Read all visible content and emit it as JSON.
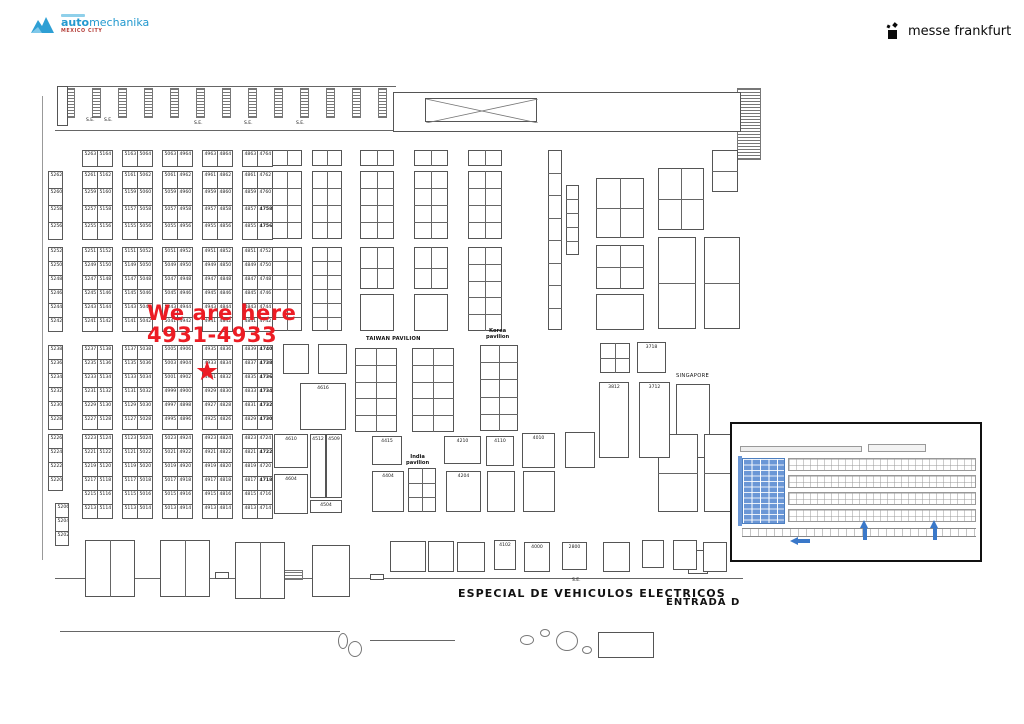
{
  "brand": {
    "part1": "auto",
    "part2": "mechanika",
    "city": "MEXICO CITY"
  },
  "organizer": {
    "name": "messe frankfurt"
  },
  "annotation": {
    "line1": "We are here",
    "line2": "4931-4933"
  },
  "star_booth": "4931",
  "se_labels": {
    "text": "S.E.",
    "positions": [
      [
        86,
        118
      ],
      [
        104,
        118
      ],
      [
        194,
        121
      ],
      [
        244,
        121
      ],
      [
        296,
        121
      ],
      [
        572,
        578
      ]
    ]
  },
  "area_labels": [
    {
      "text": "TAIWAN PAVILION",
      "x": 366,
      "y": 337,
      "size": 5.2,
      "bold": true,
      "ls": 0.2
    },
    {
      "text": "Korea\npavilion",
      "x": 486,
      "y": 329,
      "size": 5.2,
      "bold": true,
      "center": true
    },
    {
      "text": "SINGAPORE",
      "x": 676,
      "y": 374,
      "size": 5.2,
      "bold": false,
      "ls": 0.3
    },
    {
      "text": "India\npavilion",
      "x": 406,
      "y": 455,
      "size": 5.2,
      "bold": true,
      "center": true
    },
    {
      "text": "ESPECIAL DE VEHICULOS ELECTRICOS",
      "x": 458,
      "y": 588,
      "size": 11,
      "bold": true,
      "ls": 1.1
    },
    {
      "text": "ENTRADA D",
      "x": 666,
      "y": 597,
      "size": 10,
      "bold": true,
      "ls": 1.0
    }
  ],
  "booth_grid": {
    "bold_booths": [
      "4740",
      "4738",
      "4736",
      "4734",
      "4732",
      "4730",
      "4758",
      "4756",
      "4722",
      "4718"
    ],
    "bands": [
      {
        "id": "A",
        "y": 150,
        "ch": 16,
        "groups": [
          {
            "x": 82,
            "w": 30,
            "cols": [
              [
                "5263"
              ],
              [
                "5164"
              ]
            ]
          },
          {
            "x": 122,
            "w": 30,
            "cols": [
              [
                "5163"
              ],
              [
                "5064"
              ]
            ]
          },
          {
            "x": 162,
            "w": 30,
            "cols": [
              [
                "5063"
              ],
              [
                "4964"
              ]
            ]
          },
          {
            "x": 202,
            "w": 30,
            "cols": [
              [
                "4963"
              ],
              [
                "4864"
              ]
            ]
          },
          {
            "x": 242,
            "w": 30,
            "cols": [
              [
                "4863"
              ],
              [
                "4764"
              ]
            ]
          }
        ]
      },
      {
        "id": "B",
        "y": 171,
        "ch": 17,
        "groups": [
          {
            "x": 48,
            "w": 14,
            "cols": [
              [
                "5262",
                "5260",
                "5258",
                "5256"
              ]
            ]
          },
          {
            "x": 82,
            "w": 30,
            "cols": [
              [
                "5261",
                "5259",
                "5257",
                "5255"
              ],
              [
                "5162",
                "5160",
                "5158",
                "5156"
              ]
            ]
          },
          {
            "x": 122,
            "w": 30,
            "cols": [
              [
                "5161",
                "5159",
                "5157",
                "5155"
              ],
              [
                "5062",
                "5060",
                "5058",
                "5056"
              ]
            ]
          },
          {
            "x": 162,
            "w": 30,
            "cols": [
              [
                "5061",
                "5059",
                "5057",
                "5055"
              ],
              [
                "4962",
                "4960",
                "4958",
                "4956"
              ]
            ]
          },
          {
            "x": 202,
            "w": 30,
            "cols": [
              [
                "4961",
                "4959",
                "4957",
                "4955"
              ],
              [
                "4862",
                "4860",
                "4858",
                "4856"
              ]
            ]
          },
          {
            "x": 242,
            "w": 30,
            "cols": [
              [
                "4861",
                "4859",
                "4857",
                "4855"
              ],
              [
                "4762",
                "4760",
                "4758",
                "4756"
              ]
            ]
          }
        ]
      },
      {
        "id": "C",
        "y": 247,
        "ch": 14,
        "groups": [
          {
            "x": 48,
            "w": 14,
            "cols": [
              [
                "5252",
                "5250",
                "5248",
                "5246",
                "5244",
                "5242"
              ]
            ]
          },
          {
            "x": 82,
            "w": 30,
            "cols": [
              [
                "5251",
                "5249",
                "5247",
                "5245",
                "5243",
                "5241"
              ],
              [
                "5152",
                "5150",
                "5148",
                "5146",
                "5144",
                "5142"
              ]
            ]
          },
          {
            "x": 122,
            "w": 30,
            "cols": [
              [
                "5151",
                "5149",
                "5147",
                "5145",
                "5143",
                "5141"
              ],
              [
                "5052",
                "5050",
                "5048",
                "5046",
                "5044",
                "5042"
              ]
            ]
          },
          {
            "x": 162,
            "w": 30,
            "cols": [
              [
                "5051",
                "5049",
                "5047",
                "5045",
                "5043",
                "5041"
              ],
              [
                "4952",
                "4950",
                "4948",
                "4946",
                "4944",
                "4942"
              ]
            ]
          },
          {
            "x": 202,
            "w": 30,
            "cols": [
              [
                "4951",
                "4949",
                "4947",
                "4945",
                "4943",
                "4941"
              ],
              [
                "4852",
                "4850",
                "4848",
                "4846",
                "4844",
                "4842"
              ]
            ]
          },
          {
            "x": 242,
            "w": 30,
            "cols": [
              [
                "4851",
                "4849",
                "4847",
                "4845",
                "4843",
                "4841"
              ],
              [
                "4752",
                "4750",
                "4748",
                "4746",
                "4744",
                "4742"
              ]
            ]
          }
        ]
      },
      {
        "id": "D",
        "y": 345,
        "ch": 14,
        "groups": [
          {
            "x": 48,
            "w": 14,
            "cols": [
              [
                "5238",
                "5236",
                "5234",
                "5232",
                "5230",
                "5228"
              ]
            ]
          },
          {
            "x": 82,
            "w": 30,
            "cols": [
              [
                "5237",
                "5235",
                "5233",
                "5231",
                "5229",
                "5227"
              ],
              [
                "5138",
                "5136",
                "5134",
                "5132",
                "5130",
                "5128"
              ]
            ]
          },
          {
            "x": 122,
            "w": 30,
            "cols": [
              [
                "5137",
                "5135",
                "5133",
                "5131",
                "5129",
                "5127"
              ],
              [
                "5038",
                "5036",
                "5034",
                "5032",
                "5030",
                "5028"
              ]
            ]
          },
          {
            "x": 162,
            "w": 30,
            "cols": [
              [
                "5005",
                "5003",
                "5001",
                "4999",
                "4997",
                "4995"
              ],
              [
                "4906",
                "4904",
                "4902",
                "4900",
                "4898",
                "4896"
              ]
            ]
          },
          {
            "x": 202,
            "w": 30,
            "cols": [
              [
                "4935",
                "4933",
                "4931",
                "4929",
                "4927",
                "4925"
              ],
              [
                "4836",
                "4834",
                "4832",
                "4830",
                "4828",
                "4826"
              ]
            ]
          },
          {
            "x": 242,
            "w": 30,
            "cols": [
              [
                "4839",
                "4837",
                "4835",
                "4833",
                "4831",
                "4829"
              ],
              [
                "4740",
                "4738",
                "4736",
                "4734",
                "4732",
                "4730"
              ]
            ]
          }
        ]
      },
      {
        "id": "E",
        "y": 434,
        "ch": 14,
        "groups": [
          {
            "x": 48,
            "w": 14,
            "cols": [
              [
                "5226",
                "5224",
                "5222",
                "5220"
              ]
            ]
          },
          {
            "x": 82,
            "w": 30,
            "cols": [
              [
                "5223",
                "5221",
                "5219",
                "5217",
                "5215",
                "5213"
              ],
              [
                "5124",
                "5122",
                "5120",
                "5118",
                "5116",
                "5114"
              ]
            ]
          },
          {
            "x": 122,
            "w": 30,
            "cols": [
              [
                "5123",
                "5121",
                "5119",
                "5117",
                "5115",
                "5113"
              ],
              [
                "5024",
                "5022",
                "5020",
                "5018",
                "5016",
                "5014"
              ]
            ]
          },
          {
            "x": 162,
            "w": 30,
            "cols": [
              [
                "5023",
                "5021",
                "5019",
                "5017",
                "5015",
                "5013"
              ],
              [
                "4924",
                "4922",
                "4920",
                "4918",
                "4916",
                "4914"
              ]
            ]
          },
          {
            "x": 202,
            "w": 30,
            "cols": [
              [
                "4923",
                "4921",
                "4919",
                "4917",
                "4915",
                "4913"
              ],
              [
                "4824",
                "4822",
                "4820",
                "4818",
                "4816",
                "4814"
              ]
            ]
          },
          {
            "x": 242,
            "w": 30,
            "cols": [
              [
                "4823",
                "4821",
                "4819",
                "4817",
                "4815",
                "4813"
              ],
              [
                "4724",
                "4722",
                "4720",
                "4718",
                "4716",
                "4714"
              ]
            ]
          }
        ]
      },
      {
        "id": "F",
        "y": 503,
        "ch": 14,
        "groups": [
          {
            "x": 55,
            "w": 13,
            "cols": [
              [
                "5206",
                "5204",
                "5202"
              ]
            ]
          }
        ]
      }
    ]
  },
  "labeled_booths": [
    [
      "4616",
      300,
      383,
      46,
      47
    ],
    [
      "4610",
      274,
      434,
      34,
      34
    ],
    [
      "4604",
      274,
      474,
      34,
      40
    ],
    [
      "4512",
      310,
      434,
      16,
      64
    ],
    [
      "4509",
      326,
      434,
      16,
      64
    ],
    [
      "4504",
      310,
      500,
      32,
      13
    ],
    [
      "4415",
      372,
      436,
      30,
      29
    ],
    [
      "4404",
      372,
      471,
      32,
      41
    ],
    [
      "4210",
      444,
      436,
      37,
      28
    ],
    [
      "4110",
      486,
      436,
      28,
      30
    ],
    [
      "4010",
      522,
      433,
      33,
      35
    ],
    [
      "4204",
      446,
      471,
      35,
      41
    ],
    [
      "3718",
      637,
      342,
      29,
      31
    ],
    [
      "3812",
      599,
      382,
      30,
      76
    ],
    [
      "3712",
      639,
      382,
      31,
      76
    ],
    [
      "4102",
      494,
      540,
      22,
      30
    ],
    [
      "4000",
      524,
      542,
      26,
      30
    ],
    [
      "2800",
      562,
      542,
      25,
      28
    ]
  ],
  "blocks": [
    [
      272,
      150,
      30,
      16,
      1,
      2
    ],
    [
      312,
      150,
      30,
      16,
      1,
      2
    ],
    [
      360,
      150,
      34,
      16,
      1,
      2
    ],
    [
      414,
      150,
      34,
      16,
      1,
      2
    ],
    [
      468,
      150,
      34,
      16,
      1,
      2
    ],
    [
      272,
      171,
      30,
      68,
      4,
      2
    ],
    [
      312,
      171,
      30,
      68,
      4,
      2
    ],
    [
      360,
      171,
      34,
      68,
      4,
      2
    ],
    [
      414,
      171,
      34,
      68,
      4,
      2
    ],
    [
      468,
      171,
      34,
      68,
      4,
      2
    ],
    [
      596,
      178,
      48,
      60,
      2,
      2
    ],
    [
      658,
      168,
      46,
      62,
      2,
      2
    ],
    [
      712,
      150,
      26,
      42,
      2,
      1
    ],
    [
      272,
      247,
      30,
      84,
      6,
      2
    ],
    [
      312,
      247,
      30,
      84,
      6,
      2
    ],
    [
      360,
      247,
      34,
      42,
      2,
      2
    ],
    [
      414,
      247,
      34,
      42,
      2,
      2
    ],
    [
      468,
      247,
      34,
      84,
      5,
      2
    ],
    [
      360,
      294,
      34,
      37,
      1,
      1
    ],
    [
      414,
      294,
      34,
      37,
      1,
      1
    ],
    [
      596,
      245,
      48,
      44,
      2,
      2
    ],
    [
      596,
      294,
      48,
      36,
      1,
      1
    ],
    [
      658,
      237,
      38,
      92,
      2,
      1
    ],
    [
      704,
      237,
      36,
      92,
      2,
      1
    ],
    [
      548,
      150,
      14,
      180,
      8,
      1
    ],
    [
      566,
      185,
      13,
      70,
      5,
      1
    ],
    [
      283,
      344,
      26,
      30,
      1,
      1
    ],
    [
      318,
      344,
      29,
      30,
      1,
      1
    ],
    [
      355,
      348,
      42,
      84,
      5,
      2
    ],
    [
      412,
      348,
      42,
      84,
      5,
      2
    ],
    [
      480,
      345,
      38,
      86,
      5,
      2
    ],
    [
      600,
      343,
      30,
      30,
      2,
      2
    ],
    [
      676,
      384,
      34,
      74,
      1,
      1
    ],
    [
      408,
      468,
      28,
      44,
      3,
      2
    ],
    [
      565,
      432,
      30,
      36,
      1,
      1
    ],
    [
      487,
      471,
      28,
      41,
      1,
      1
    ],
    [
      523,
      471,
      32,
      41,
      1,
      1
    ],
    [
      658,
      434,
      40,
      78,
      2,
      1
    ],
    [
      704,
      434,
      34,
      78,
      2,
      1
    ],
    [
      85,
      540,
      50,
      57,
      1,
      2
    ],
    [
      160,
      540,
      50,
      57,
      1,
      2
    ],
    [
      235,
      542,
      50,
      57,
      1,
      2
    ],
    [
      312,
      545,
      38,
      52,
      1,
      1
    ],
    [
      390,
      541,
      36,
      31,
      1,
      1
    ],
    [
      428,
      541,
      26,
      31,
      1,
      1
    ],
    [
      457,
      542,
      28,
      30,
      1,
      1
    ],
    [
      603,
      542,
      27,
      30,
      1,
      1
    ],
    [
      642,
      540,
      22,
      28,
      1,
      1
    ],
    [
      673,
      540,
      24,
      30,
      1,
      1
    ],
    [
      703,
      542,
      24,
      30,
      1,
      1
    ]
  ],
  "minimap": {
    "highlight_color": "#6b97d6",
    "arrow_color": "#3a78c9"
  }
}
